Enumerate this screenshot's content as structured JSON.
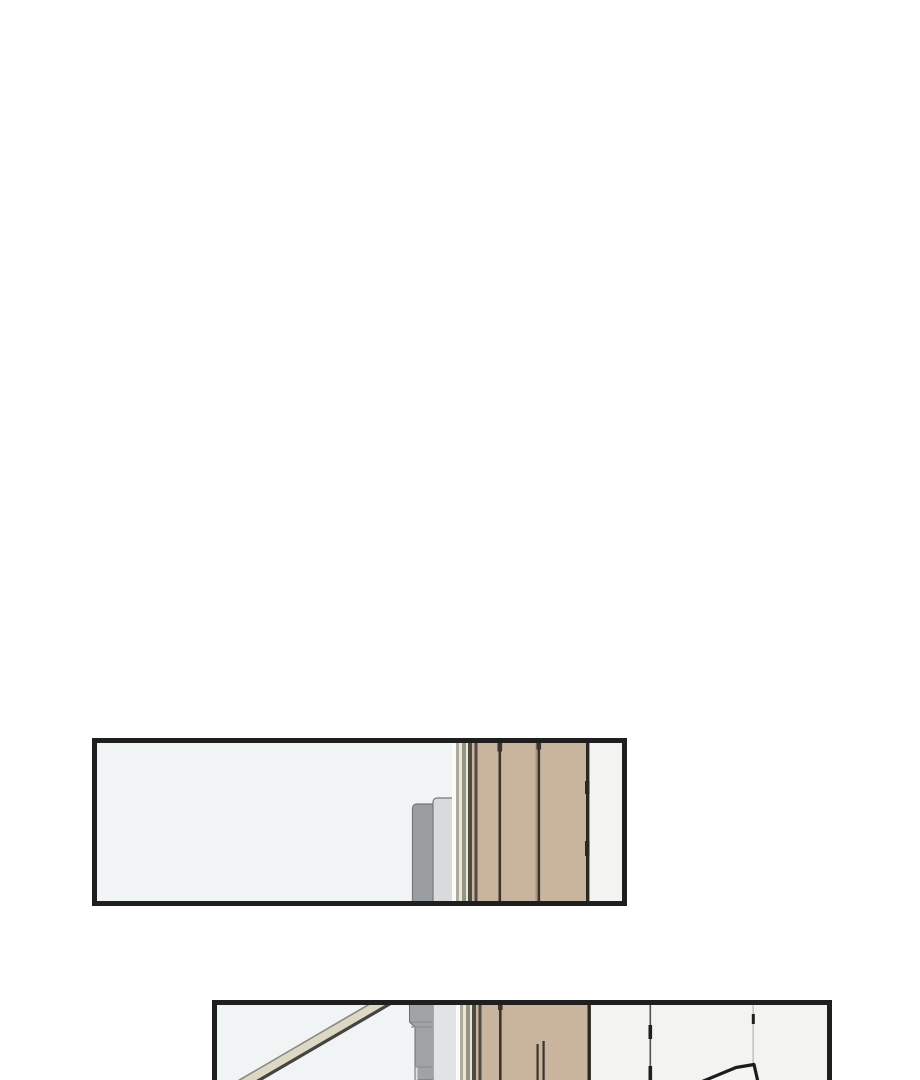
{
  "page": {
    "kind": "webtoon-comic-page-segment",
    "panel_count": 2
  },
  "colors": {
    "page_bg": "#ffffff",
    "panel_border": "#1f1f1f",
    "wall": "#f1f4f5",
    "wood": "#c9b49e",
    "wood_seam": "#3a342c",
    "wood_seam_faint": "#a5947f",
    "wood_edge_dark": "#2b2723",
    "furniture_gray_dark": "#9b9ea1",
    "furniture_gray_light": "#d8dadb",
    "furniture_outline": "#75777a",
    "offwhite_panel": "#f3f3f1",
    "panel_seam_gray": "#55524e",
    "panel_seam_tick": "#1f1f1f",
    "panel_seam_light": "#b9b9b9",
    "trim_white": "#fafaf8",
    "trim_olive": "#aeab9c",
    "trim_olive_dark": "#989482",
    "trim_cream": "#e9e6da",
    "trim_dark": "#4f4a43",
    "railing_fill": "#dcd8c5",
    "railing_edge_light": "#8a897f",
    "railing_edge_dark": "#45443f",
    "doorframe_gray": "#a0a3a5",
    "doorframe_gray_light": "#e2e3e4",
    "doorframe_outline": "#6a6c6e",
    "doorframe_step": "#8d9092",
    "doorframe_step_light": "#dfe0e1",
    "object_outline": "#1c1c1c",
    "object_fill": "#f5f5f4"
  },
  "panels": [
    {
      "name": "top-panel",
      "scene": "pale interior wall, gray furniture backrest, slatted trim, tan wooden wall panels, off-white panel strip"
    },
    {
      "name": "bottom-panel",
      "scene": "diagonal stair handrail, gray door frame, slatted trim, tan wooden wall panels, off-white wall panels, cropped dark-outlined object"
    }
  ]
}
